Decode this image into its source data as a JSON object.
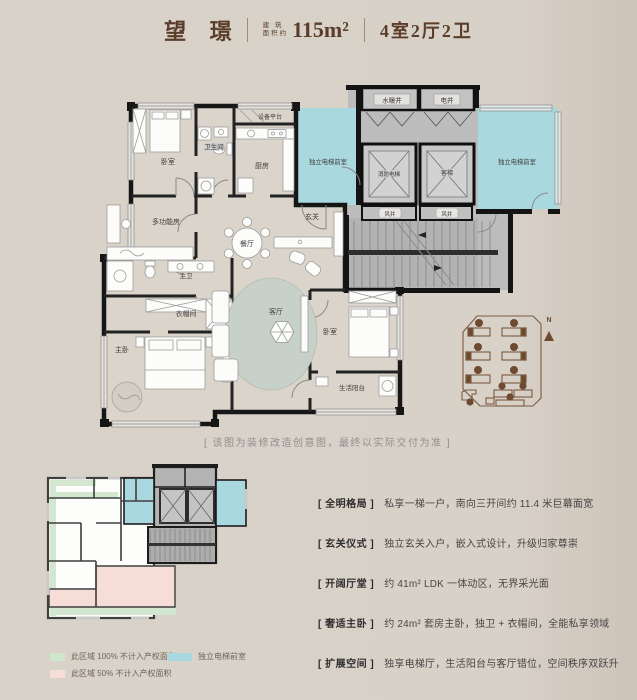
{
  "header": {
    "project_name": "望 璟",
    "area_label_line1": "建 筑",
    "area_label_line2": "面积约",
    "area_value": "115m²",
    "layout_spec": "4室2厅2卫"
  },
  "floorplan": {
    "rooms": {
      "bedroom_top": "卧室",
      "bathroom": "卫生间",
      "equipment_platform": "设备平台",
      "kitchen": "厨房",
      "multifunction_room": "多功能房",
      "master_bath": "主卫",
      "cloakroom": "衣帽间",
      "master_bedroom": "主卧",
      "dining_room": "餐厅",
      "foyer": "玄关",
      "living_room": "客厅",
      "bedroom_bottom": "卧室",
      "life_balcony": "生活阳台"
    },
    "core": {
      "water_heating_shaft": "水暖井",
      "electric_shaft": "电井",
      "fire_elevator": "消防电梯",
      "passenger_elevator": "客梯",
      "wind_shaft_left": "风井",
      "wind_shaft_right": "风井",
      "elevator_lobby_left": "独立电梯前室",
      "elevator_lobby_right": "独立电梯前室"
    },
    "site_plan": {
      "north_label": "N"
    }
  },
  "caption": "[ 该图为装修改造创意图，最终以实际交付为准 ]",
  "legend": {
    "items": [
      {
        "label": "此区域 100% 不计入产权面积",
        "color": "#cfe6cc"
      },
      {
        "label": "此区域 50% 不计入产权面积",
        "color": "#f8ded8"
      },
      {
        "label": "独立电梯前室",
        "color": "#a9d8de"
      }
    ]
  },
  "features": [
    {
      "tag": "[ 全明格局 ]",
      "desc": "私享一梯一户，南向三开间约 11.4 米巨幕面宽"
    },
    {
      "tag": "[ 玄关仪式 ]",
      "desc": "独立玄关入户，嵌入式设计，升级归家尊崇"
    },
    {
      "tag": "[ 开阔厅堂 ]",
      "desc": "约 41m² LDK 一体动区，无界采光面"
    },
    {
      "tag": "[ 奢适主卧 ]",
      "desc": "约 24m² 套房主卧，独卫 + 衣帽间，全能私享领域"
    },
    {
      "tag": "[ 扩展空间 ]",
      "desc": "独享电梯厅，生活阳台与客厅错位，空间秩序双跃升"
    }
  ],
  "colors": {
    "page_background": "#d8d1c8",
    "title_brown": "#5b3e2a",
    "lobby_teal": "#a9d8de",
    "legend_green": "#cfe6cc",
    "legend_pink": "#f8ded8",
    "site_plan_brown": "#7a5a40",
    "core_gray": "#bcbcbc"
  }
}
